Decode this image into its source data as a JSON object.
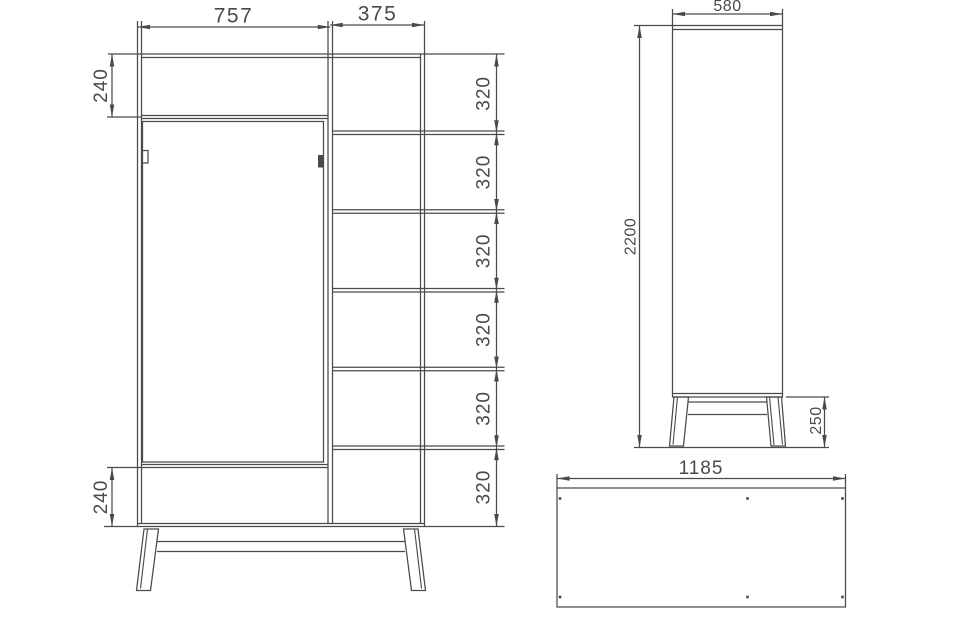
{
  "drawing": {
    "front_view": {
      "width_door_section": "757",
      "width_shelf_section": "375",
      "top_section_height": "240",
      "shelf_heights": [
        "320",
        "320",
        "320",
        "320",
        "320",
        "320"
      ],
      "bottom_section_height": "240"
    },
    "side_view": {
      "depth": "580",
      "total_height": "2200",
      "leg_height": "250"
    },
    "top_view": {
      "total_width": "1185"
    }
  },
  "colors": {
    "line": "#4a4a4a",
    "background": "#ffffff"
  }
}
